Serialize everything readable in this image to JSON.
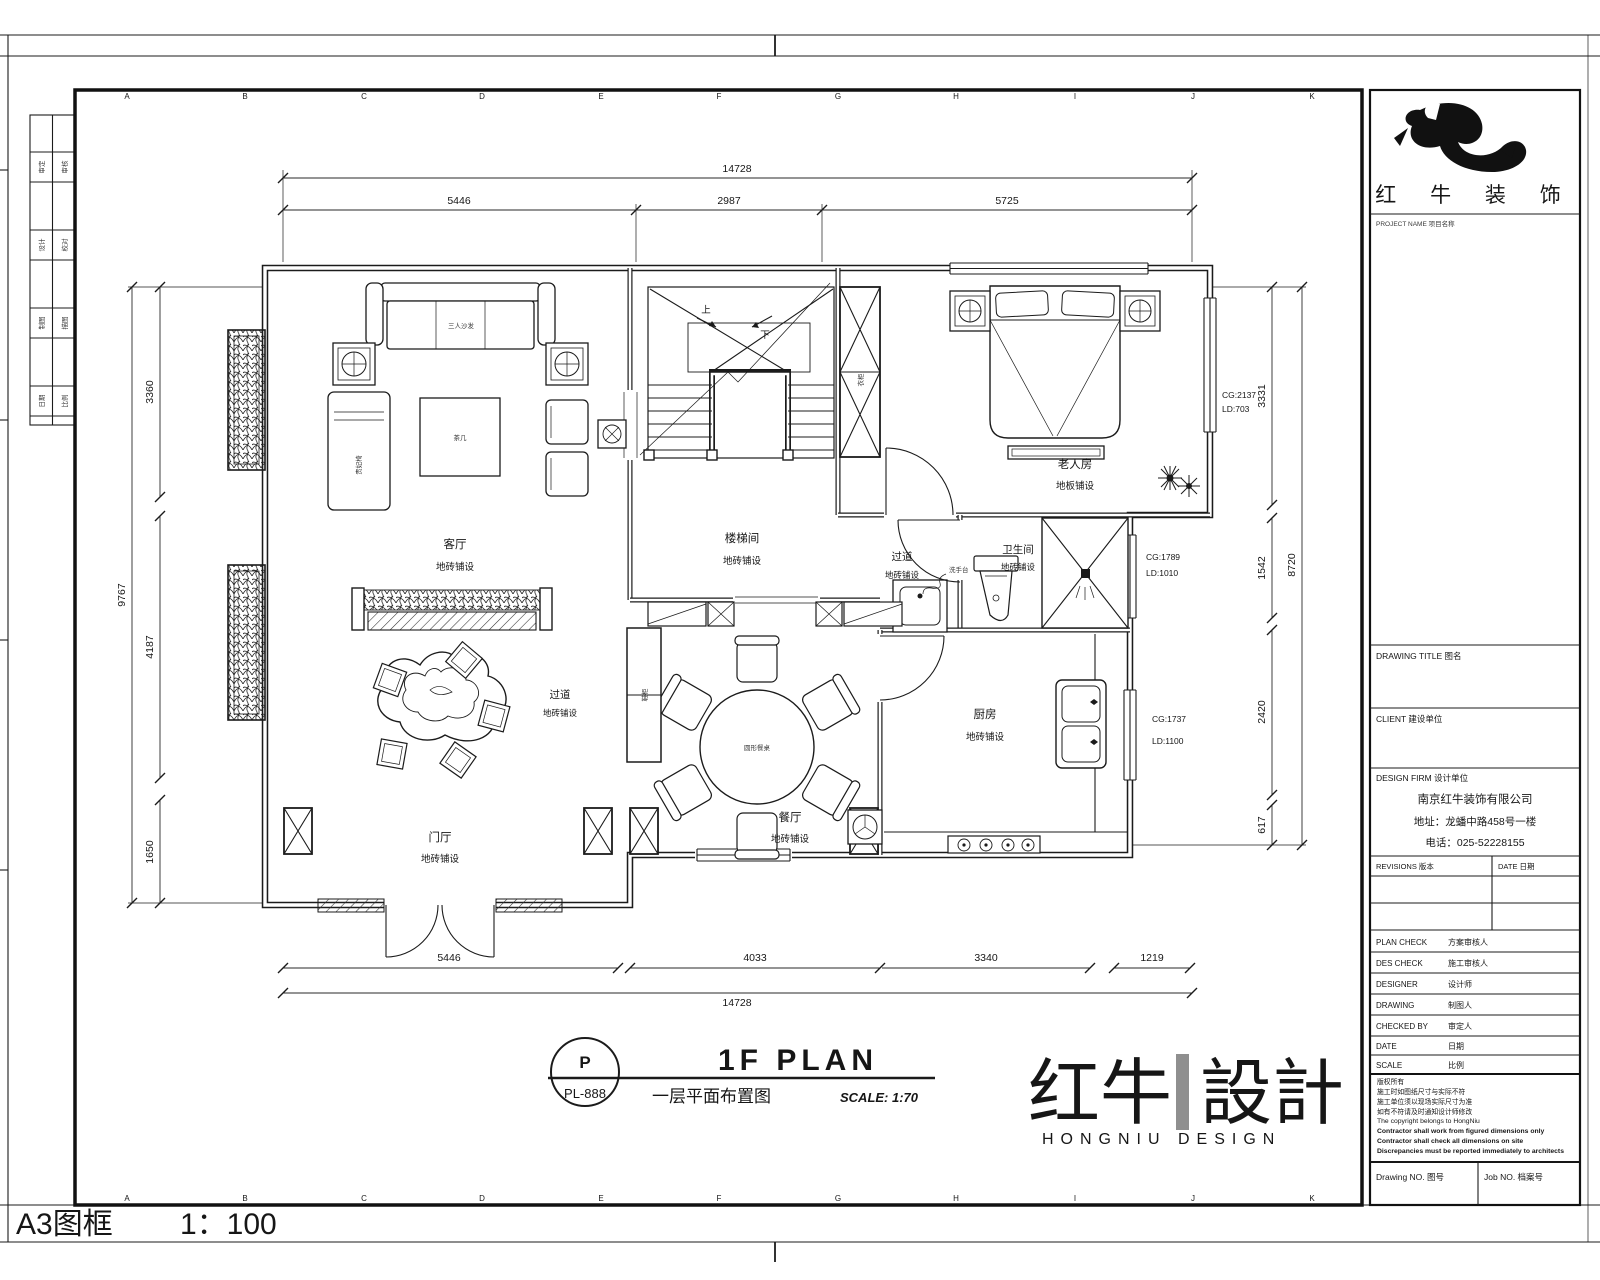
{
  "page": {
    "a3_label": "A3图框",
    "a3_scale": "1：100"
  },
  "titlebar": {
    "code_top": "P",
    "code_bottom": "PL-888",
    "title_en": "1F PLAN",
    "title_cn": "一层平面布置图",
    "scale_note": "SCALE: 1:70"
  },
  "watermark": {
    "cn_left": "红牛",
    "cn_right": "設計",
    "en": "HONGNIU DESIGN"
  },
  "title_block": {
    "logo_cn": "红 牛 装 饰",
    "logo_caption": "PROJECT NAME 项目名称",
    "drawing_title_label": "DRAWING TITLE 图名",
    "client_label": "CLIENT 建设单位",
    "design_firm_label": "DESIGN FIRM 设计单位",
    "company_name": "南京红牛装饰有限公司",
    "company_addr": "地址：龙蟠中路458号一楼",
    "company_tel": "电话：025-52228155",
    "revisions_label": "REVISIONS 版本",
    "date_col_label": "DATE 日期",
    "rows": [
      {
        "en": "PLAN CHECK",
        "cn": "方案审核人"
      },
      {
        "en": "DES CHECK",
        "cn": "施工审核人"
      },
      {
        "en": "DESIGNER",
        "cn": "设计师"
      },
      {
        "en": "DRAWING",
        "cn": "制图人"
      },
      {
        "en": "CHECKED BY",
        "cn": "审定人"
      },
      {
        "en": "DATE",
        "cn": "日期"
      },
      {
        "en": "SCALE",
        "cn": "比例"
      }
    ],
    "notes": [
      "版权所有",
      "施工时如图纸尺寸与实际不符",
      "施工单位须以现场实际尺寸为准",
      "如有不符请及时通知设计师修改",
      "The copyright belongs to HongNiu",
      "Contractor shall work from figured dimensions only",
      "Contractor shall check all dimensions on site",
      "Discrepancies must be reported immediately to architects"
    ],
    "drawing_no_label": "Drawing NO. 图号",
    "job_no_label": "Job NO. 档案号"
  },
  "plan": {
    "grid_letters": [
      "A",
      "B",
      "C",
      "D",
      "E",
      "F",
      "G",
      "H",
      "I",
      "J",
      "K"
    ],
    "fold_labels": [
      [
        "审定",
        "审核"
      ],
      [
        "设计",
        "校对"
      ],
      [
        "制图",
        "描图"
      ],
      [
        "日期",
        "比例"
      ]
    ],
    "dims": {
      "top_total": "14728",
      "top": [
        "5446",
        "2987",
        "5725"
      ],
      "bottom": [
        "5446",
        "4033",
        "3340",
        "1219"
      ],
      "bottom_total": "14728",
      "left": [
        "3360",
        "4187",
        "1650"
      ],
      "left_total": "9767",
      "right": [
        "3331",
        "1542",
        "2420",
        "617"
      ],
      "right_total": "8720"
    },
    "rooms": [
      {
        "name": "客厅",
        "finish": "地砖铺设"
      },
      {
        "name": "楼梯间",
        "finish": "地砖铺设"
      },
      {
        "name": "过道",
        "finish": "地砖铺设"
      },
      {
        "name": "老人房",
        "finish": "地板铺设"
      },
      {
        "name": "卫生间",
        "finish": "地砖铺设"
      },
      {
        "name": "厨房",
        "finish": "地砖铺设"
      },
      {
        "name": "餐厅",
        "finish": "地砖铺设"
      },
      {
        "name": "门厅",
        "finish": "地砖铺设"
      },
      {
        "name": "过道",
        "finish": "地砖铺设"
      }
    ],
    "annotations": [
      {
        "l1": "CG:2137",
        "l2": "LD:703"
      },
      {
        "l1": "CG:1789",
        "l2": "LD:1010"
      },
      {
        "l1": "CG:1737",
        "l2": "LD:1100"
      }
    ],
    "stair": {
      "up": "上",
      "down": "下"
    },
    "furniture": {
      "sofa": "三人沙发",
      "table": "茶几",
      "chaise": "贵妃椅",
      "dining_table": "圆形餐桌",
      "wardrobe": "衣柜",
      "shoe_cabinet": "鞋柜",
      "basin": "洗手台"
    }
  }
}
